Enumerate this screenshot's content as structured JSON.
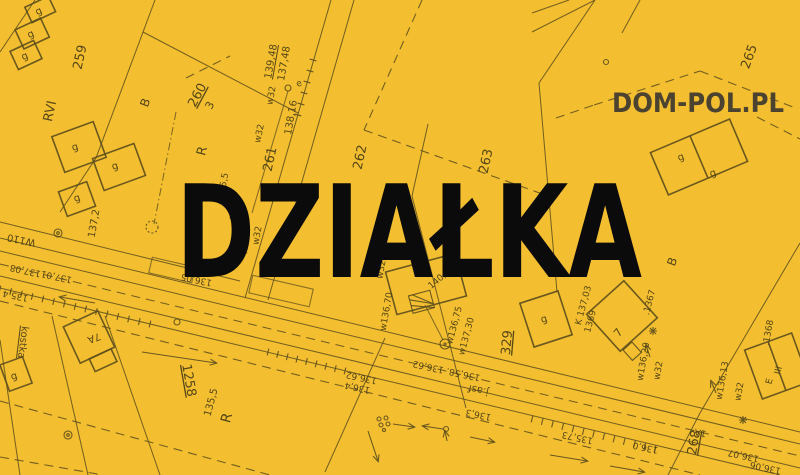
{
  "meta": {
    "width": 800,
    "height": 475,
    "kind": "real-estate plot placeholder over cadastral survey map"
  },
  "branding": {
    "headline": "DZIAŁKA",
    "watermark": "DOM-POL.PL"
  },
  "colors": {
    "background": "#F3BE30",
    "map_line": "#5B4D1C",
    "map_text": "#4E4115",
    "headline": "#0B0B0B",
    "watermark": "#4B4230"
  },
  "map_labels": [
    {
      "t": "g",
      "x": 40,
      "y": 14,
      "r": -25,
      "s": 10
    },
    {
      "t": "g",
      "x": 32,
      "y": 37,
      "r": -25,
      "s": 10
    },
    {
      "t": "g",
      "x": 26,
      "y": 59,
      "r": -25,
      "s": 10
    },
    {
      "t": "259",
      "x": 84,
      "y": 58,
      "r": -78,
      "s": 13
    },
    {
      "t": "RVI",
      "x": 54,
      "y": 112,
      "r": -78,
      "s": 13
    },
    {
      "t": "B",
      "x": 149,
      "y": 104,
      "r": -70,
      "s": 12
    },
    {
      "t": "260",
      "x": 201,
      "y": 97,
      "r": -62,
      "s": 13,
      "u": true
    },
    {
      "t": "3",
      "x": 213,
      "y": 107,
      "r": -62,
      "s": 11
    },
    {
      "t": "R",
      "x": 206,
      "y": 152,
      "r": -75,
      "s": 13
    },
    {
      "t": "g",
      "x": 76,
      "y": 150,
      "r": -20,
      "s": 10
    },
    {
      "t": "g",
      "x": 116,
      "y": 169,
      "r": -20,
      "s": 10
    },
    {
      "t": "g",
      "x": 78,
      "y": 201,
      "r": -20,
      "s": 10
    },
    {
      "t": "137,2",
      "x": 97,
      "y": 224,
      "r": -80,
      "s": 10
    },
    {
      "t": "W110",
      "x": 22,
      "y": 237,
      "r": 192,
      "s": 10
    },
    {
      "t": "137,08",
      "x": 26,
      "y": 268,
      "r": 192,
      "s": 9
    },
    {
      "t": "137,01",
      "x": 57,
      "y": 274,
      "r": 192,
      "s": 9
    },
    {
      "t": "135,4",
      "x": 16,
      "y": 293,
      "r": 192,
      "s": 9
    },
    {
      "t": "139,48",
      "x": 274,
      "y": 62,
      "r": -80,
      "s": 10,
      "u": true
    },
    {
      "t": "137,48",
      "x": 287,
      "y": 64,
      "r": -80,
      "s": 10
    },
    {
      "t": "e",
      "x": 300,
      "y": 86,
      "r": -20,
      "s": 9
    },
    {
      "t": "w32",
      "x": 274,
      "y": 96,
      "r": -80,
      "s": 9
    },
    {
      "t": "138,16",
      "x": 294,
      "y": 118,
      "r": -80,
      "s": 10
    },
    {
      "t": "261",
      "x": 274,
      "y": 160,
      "r": -78,
      "s": 13
    },
    {
      "t": "w32",
      "x": 262,
      "y": 134,
      "r": -78,
      "s": 9
    },
    {
      "t": "262",
      "x": 364,
      "y": 158,
      "r": -78,
      "s": 13
    },
    {
      "t": "263",
      "x": 490,
      "y": 162,
      "r": -78,
      "s": 13
    },
    {
      "t": "265",
      "x": 753,
      "y": 58,
      "r": -70,
      "s": 13
    },
    {
      "t": "135,5",
      "x": 226,
      "y": 186,
      "r": -80,
      "s": 9
    },
    {
      "t": "136,9",
      "x": 238,
      "y": 208,
      "r": -80,
      "s": 9
    },
    {
      "t": "tA",
      "x": 244,
      "y": 256,
      "r": -40,
      "s": 9
    },
    {
      "t": "w32",
      "x": 260,
      "y": 236,
      "r": -80,
      "s": 9
    },
    {
      "t": "136,05",
      "x": 197,
      "y": 277,
      "r": 192,
      "s": 9
    },
    {
      "t": "w32",
      "x": 384,
      "y": 270,
      "r": -80,
      "s": 9
    },
    {
      "t": "w136,70",
      "x": 389,
      "y": 312,
      "r": -80,
      "s": 9
    },
    {
      "t": "140,9",
      "x": 441,
      "y": 281,
      "r": -40,
      "s": 9
    },
    {
      "t": "w136,75",
      "x": 457,
      "y": 326,
      "r": -75,
      "s": 9
    },
    {
      "t": "w137,30",
      "x": 469,
      "y": 337,
      "r": -75,
      "s": 9
    },
    {
      "t": "329",
      "x": 511,
      "y": 343,
      "r": -85,
      "s": 13,
      "u": true
    },
    {
      "t": "g",
      "x": 545,
      "y": 322,
      "r": -20,
      "s": 10
    },
    {
      "t": "K 137,03",
      "x": 586,
      "y": 306,
      "r": -75,
      "s": 9
    },
    {
      "t": "1369",
      "x": 593,
      "y": 322,
      "r": -75,
      "s": 9
    },
    {
      "t": "B",
      "x": 676,
      "y": 263,
      "r": -70,
      "s": 12
    },
    {
      "t": "g",
      "x": 682,
      "y": 160,
      "r": -23,
      "s": 10
    },
    {
      "t": "g",
      "x": 714,
      "y": 176,
      "r": -23,
      "s": 10
    },
    {
      "t": ".1367",
      "x": 652,
      "y": 303,
      "r": -75,
      "s": 9
    },
    {
      "t": "7",
      "x": 621,
      "y": 335,
      "r": -50,
      "s": 11
    },
    {
      "t": "w136,20",
      "x": 646,
      "y": 362,
      "r": -80,
      "s": 9
    },
    {
      "t": "w32",
      "x": 661,
      "y": 371,
      "r": -80,
      "s": 9
    },
    {
      "t": ".1368",
      "x": 771,
      "y": 333,
      "r": -80,
      "s": 9
    },
    {
      "t": "w136,13",
      "x": 725,
      "y": 381,
      "r": -80,
      "s": 9
    },
    {
      "t": "w32",
      "x": 742,
      "y": 392,
      "r": -80,
      "s": 9
    },
    {
      "t": "III",
      "x": 781,
      "y": 371,
      "r": -75,
      "s": 9
    },
    {
      "t": "E",
      "x": 772,
      "y": 382,
      "r": -75,
      "s": 9
    },
    {
      "t": "1A",
      "x": 701,
      "y": 430,
      "r": 192,
      "s": 9
    },
    {
      "t": "268",
      "x": 698,
      "y": 443,
      "r": -80,
      "s": 13,
      "u": true
    },
    {
      "t": "136,0",
      "x": 646,
      "y": 445,
      "r": 192,
      "s": 9
    },
    {
      "t": "136,07",
      "x": 744,
      "y": 453,
      "r": 192,
      "s": 9
    },
    {
      "t": "136,06",
      "x": 766,
      "y": 465,
      "r": 192,
      "s": 9
    },
    {
      "t": "135,73",
      "x": 578,
      "y": 435,
      "r": 192,
      "s": 9
    },
    {
      "t": "136,58. 136,62",
      "x": 447,
      "y": 368,
      "r": 192,
      "s": 9
    },
    {
      "t": "136,62",
      "x": 362,
      "y": 375,
      "r": 192,
      "s": 9
    },
    {
      "t": "136,4",
      "x": 358,
      "y": 385,
      "r": 192,
      "s": 9
    },
    {
      "t": "j.asf",
      "x": 479,
      "y": 387,
      "r": 192,
      "s": 10
    },
    {
      "t": "136,3",
      "x": 479,
      "y": 412,
      "r": 192,
      "s": 9
    },
    {
      "t": "kostka",
      "x": 20,
      "y": 342,
      "r": 97,
      "s": 10,
      "u": true
    },
    {
      "t": "7A",
      "x": 93,
      "y": 335,
      "r": 160,
      "s": 10
    },
    {
      "t": "g",
      "x": 15,
      "y": 379,
      "r": -20,
      "s": 10
    },
    {
      "t": "1258",
      "x": 185,
      "y": 381,
      "r": 80,
      "s": 13,
      "u": true
    },
    {
      "t": "135,5",
      "x": 214,
      "y": 403,
      "r": -75,
      "s": 10
    },
    {
      "t": "R",
      "x": 231,
      "y": 419,
      "r": -75,
      "s": 14
    }
  ]
}
